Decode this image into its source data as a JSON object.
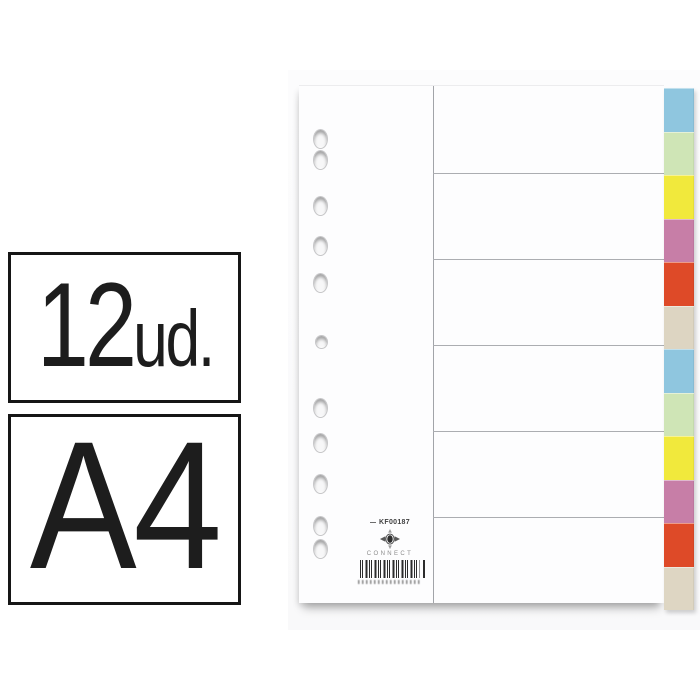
{
  "badges": {
    "units_value": "12",
    "units_suffix": "ud.",
    "format": "A4"
  },
  "product": {
    "code": "KF00187",
    "brand": "CONNECT",
    "tab_count": 12,
    "hole_count": 11,
    "tab_colors": [
      "#8fc6df",
      "#cfe5b6",
      "#f1e93c",
      "#c77ea7",
      "#de4a28",
      "#ddd5c2",
      "#8fc6df",
      "#cfe5b6",
      "#f1e93c",
      "#c77ea7",
      "#de4a28",
      "#ded6c3"
    ],
    "sheet_color": "#fdfdfe",
    "rule_line_color": "#a8aaae"
  }
}
